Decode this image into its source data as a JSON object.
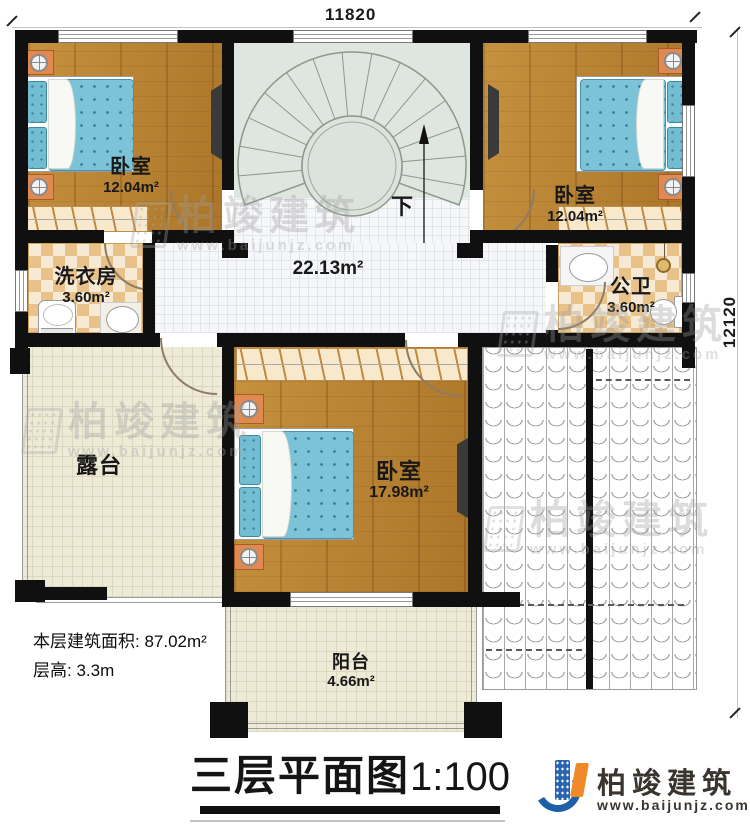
{
  "dimensions": {
    "top": "11820",
    "right": "12120"
  },
  "stairs": {
    "down_label": "下"
  },
  "rooms": {
    "bedroom_top_left": {
      "name": "卧室",
      "area": "12.04m²"
    },
    "bedroom_top_right": {
      "name": "卧室",
      "area": "12.04m²"
    },
    "bedroom_main": {
      "name": "卧室",
      "area": "17.98m²"
    },
    "laundry": {
      "name": "洗衣房",
      "area": "3.60m²"
    },
    "bathroom": {
      "name": "公卫",
      "area": "3.60m²"
    },
    "hall": {
      "area": "22.13m²"
    },
    "terrace": {
      "name": "露台"
    },
    "balcony": {
      "name": "阳台",
      "area": "4.66m²"
    }
  },
  "notes": {
    "floor_area": "本层建筑面积: 87.02m²",
    "floor_height": "层高: 3.3m"
  },
  "title": {
    "name": "三层平面图",
    "scale": "1:100"
  },
  "brand": {
    "name": "柏竣建筑",
    "url": "www.baijunjz.com"
  },
  "watermark": {
    "name": "柏竣建筑",
    "url": "www.baijunjz.com"
  },
  "colors": {
    "wall": "#101010",
    "wood": "#b5812f",
    "stair_fill": "#dfe5df",
    "hall_tile": "#f6f7f9",
    "outdoor_tile": "#edead8",
    "checker": "#e9c289",
    "bed_blue": "#7cc3d8",
    "nightstand_orange": "#e08a52",
    "brand_blue": "#1d5fa8",
    "brand_orange": "#f08a28"
  }
}
